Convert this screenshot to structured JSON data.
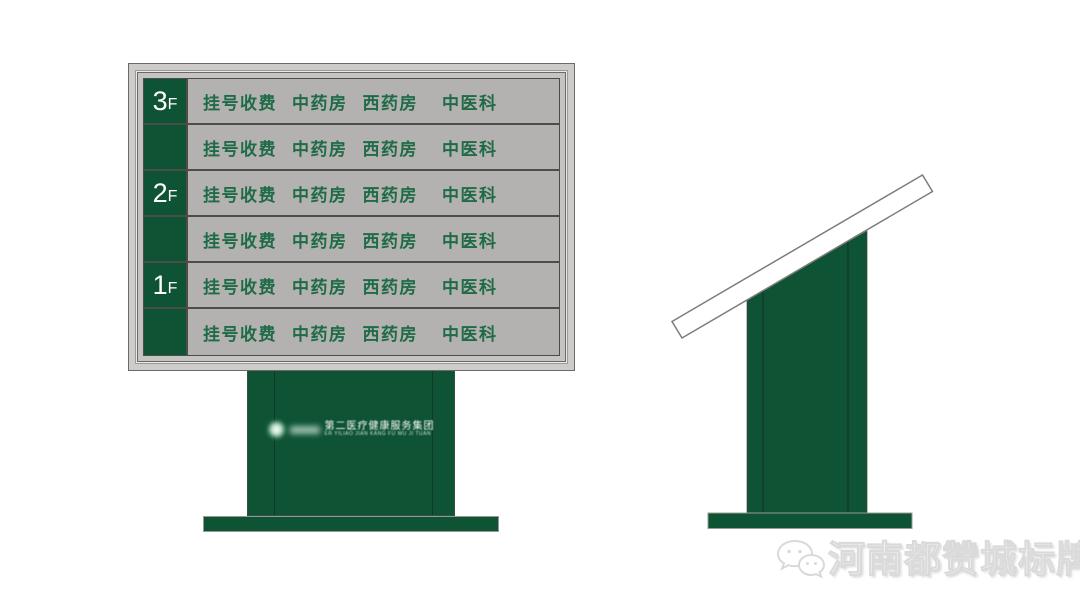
{
  "colors": {
    "green": "#0e5334",
    "row_gray": "#b4b2b0",
    "frame_gray": "#cdccca",
    "frame_mid": "#c5c4c2",
    "gap_light": "#e9e9e7",
    "text_green": "#1f6b48",
    "separator": "#4c4c48",
    "outline": "#6a6a66",
    "base_outline": "#989896",
    "bar_outline": "#7d7d7b",
    "watermark_gray": "#ececec",
    "white": "#ffffff"
  },
  "board": {
    "rows": [
      {
        "floor": "3",
        "floor_suffix": "F",
        "items": [
          "挂号收费",
          "中药房",
          "西药房",
          "中医科"
        ]
      },
      {
        "floor": "",
        "floor_suffix": "",
        "items": [
          "挂号收费",
          "中药房",
          "西药房",
          "中医科"
        ]
      },
      {
        "floor": "2",
        "floor_suffix": "F",
        "items": [
          "挂号收费",
          "中药房",
          "西药房",
          "中医科"
        ]
      },
      {
        "floor": "",
        "floor_suffix": "",
        "items": [
          "挂号收费",
          "中药房",
          "西药房",
          "中医科"
        ]
      },
      {
        "floor": "1",
        "floor_suffix": "F",
        "items": [
          "挂号收费",
          "中药房",
          "西药房",
          "中医科"
        ]
      },
      {
        "floor": "",
        "floor_suffix": "",
        "items": [
          "挂号收费",
          "中药房",
          "西药房",
          "中医科"
        ]
      }
    ]
  },
  "pedestal": {
    "logo_icon": "emblem-icon",
    "logo_cn": "第二医疗健康服务集团",
    "logo_pinyin": "ER YILIAO JIAN KANG FU WU JI TUAN"
  },
  "watermark": {
    "icon": "wechat-icon",
    "text": "河南都赞城标牌厂"
  }
}
